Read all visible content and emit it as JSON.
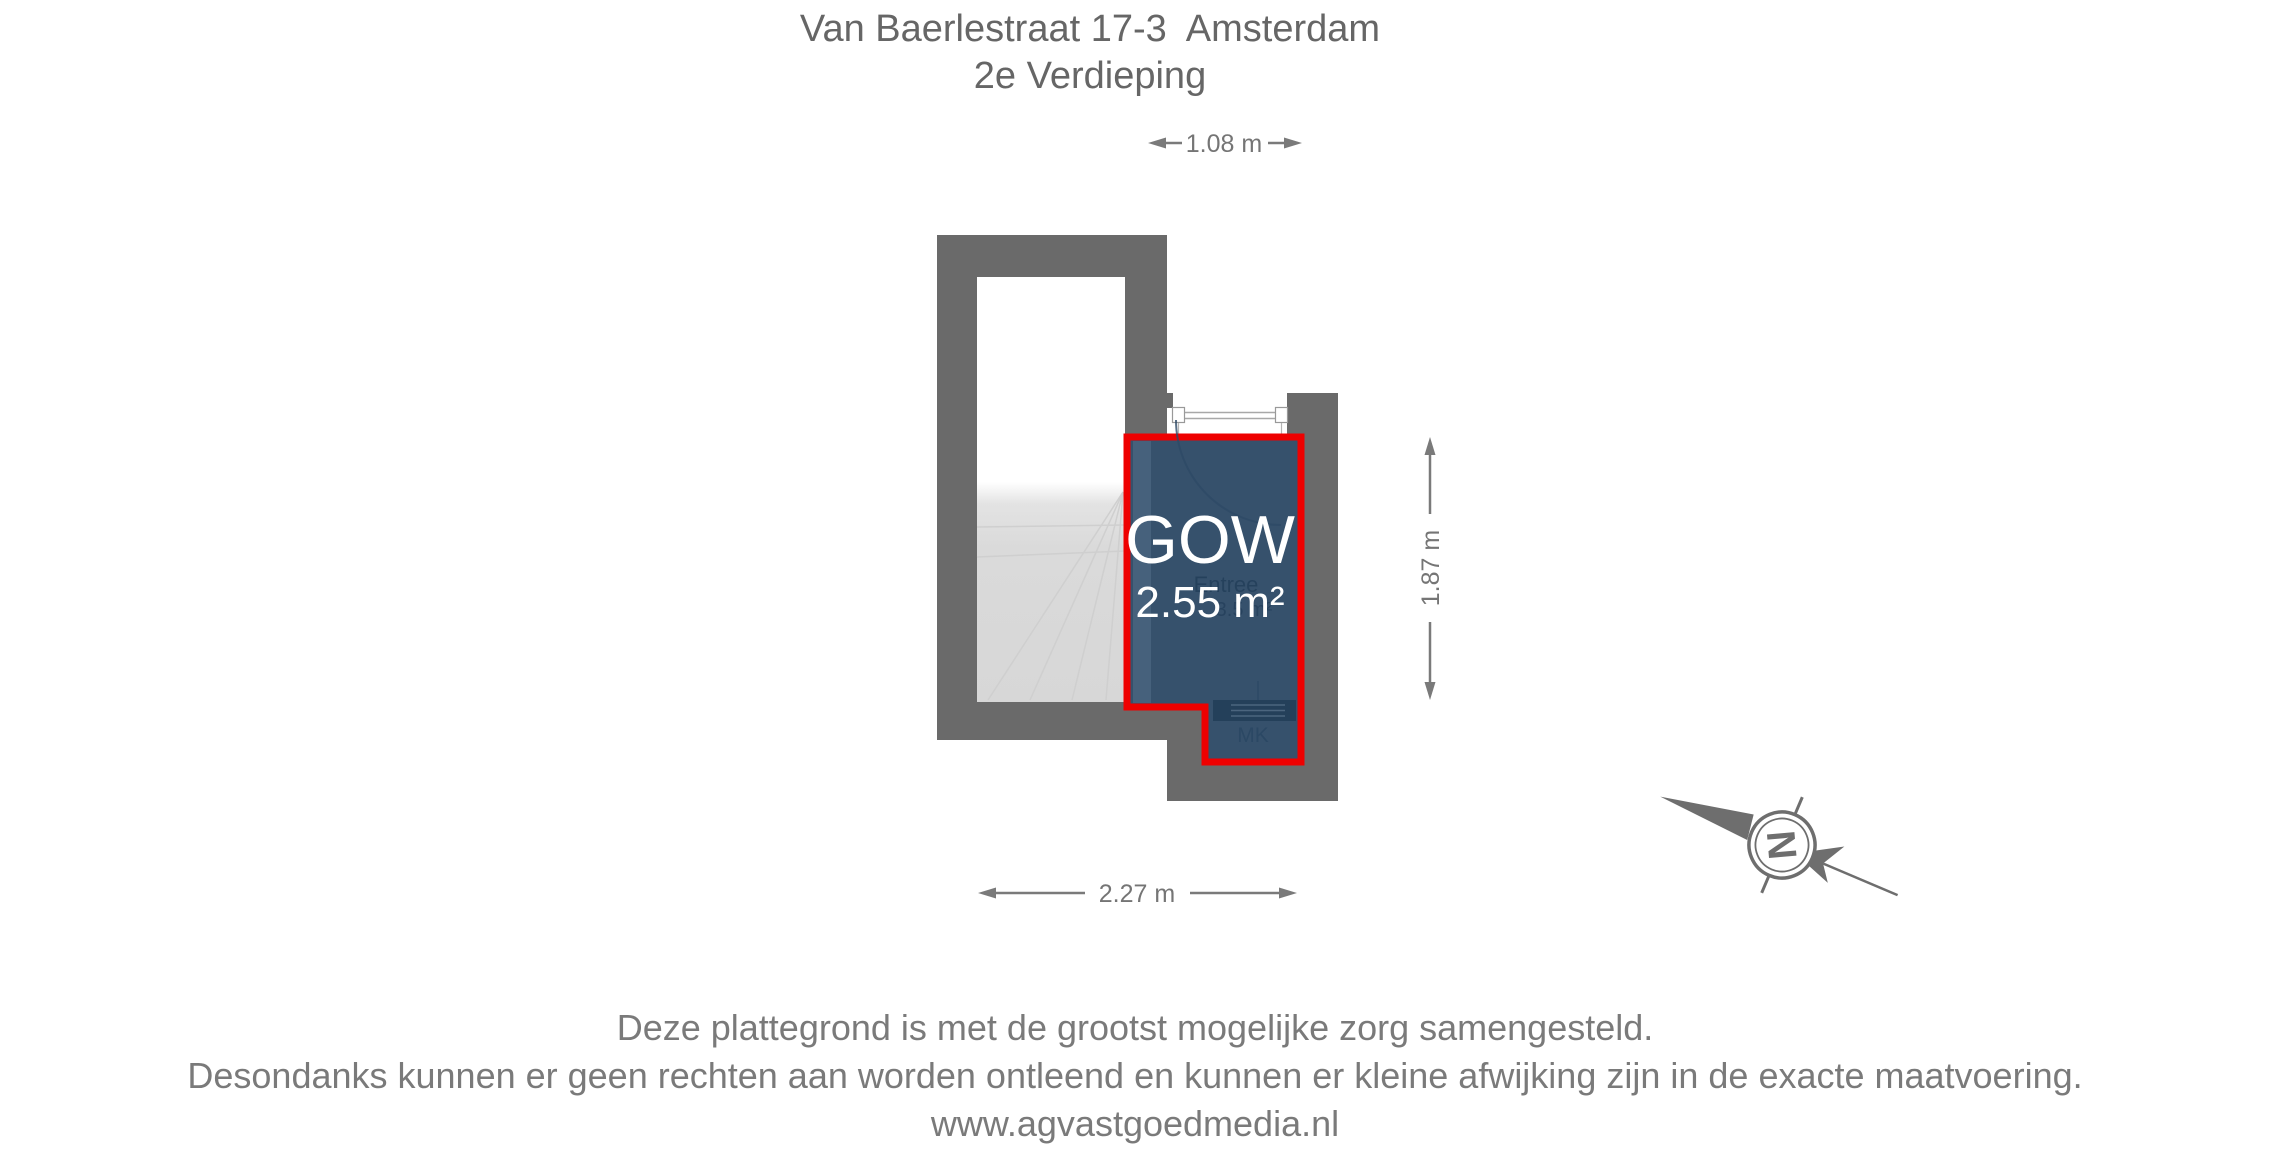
{
  "header": {
    "address": "Van Baerlestraat 17-3  Amsterdam",
    "floor": "2e Verdieping"
  },
  "plan": {
    "room_label": "GOW",
    "room_area": "2.55 m²",
    "original_room_name": "Entree",
    "original_room_area": "3.5 m²",
    "meter_closet_label": "MK",
    "dim_top": "1.08 m",
    "dim_right": "1.87 m",
    "dim_bottom": "2.27 m"
  },
  "compass": {
    "north_label": "N"
  },
  "footer": {
    "disclaimer_line1": "Deze plattegrond is met de grootst mogelijke zorg samengesteld.",
    "disclaimer_line2": "Desondanks kunnen er geen rechten aan worden ontleend en kunnen er kleine afwijking zijn in de exacte maatvoering.",
    "website": "www.agvastgoedmedia.nl"
  },
  "colors": {
    "wall_gray": "#6a6a6a",
    "highlight_fill": "#36516c",
    "highlight_outline": "#ee0000",
    "stairs_gray": "#dadada",
    "dimension_text": "#757575",
    "footer_text": "#7a7a7a"
  }
}
